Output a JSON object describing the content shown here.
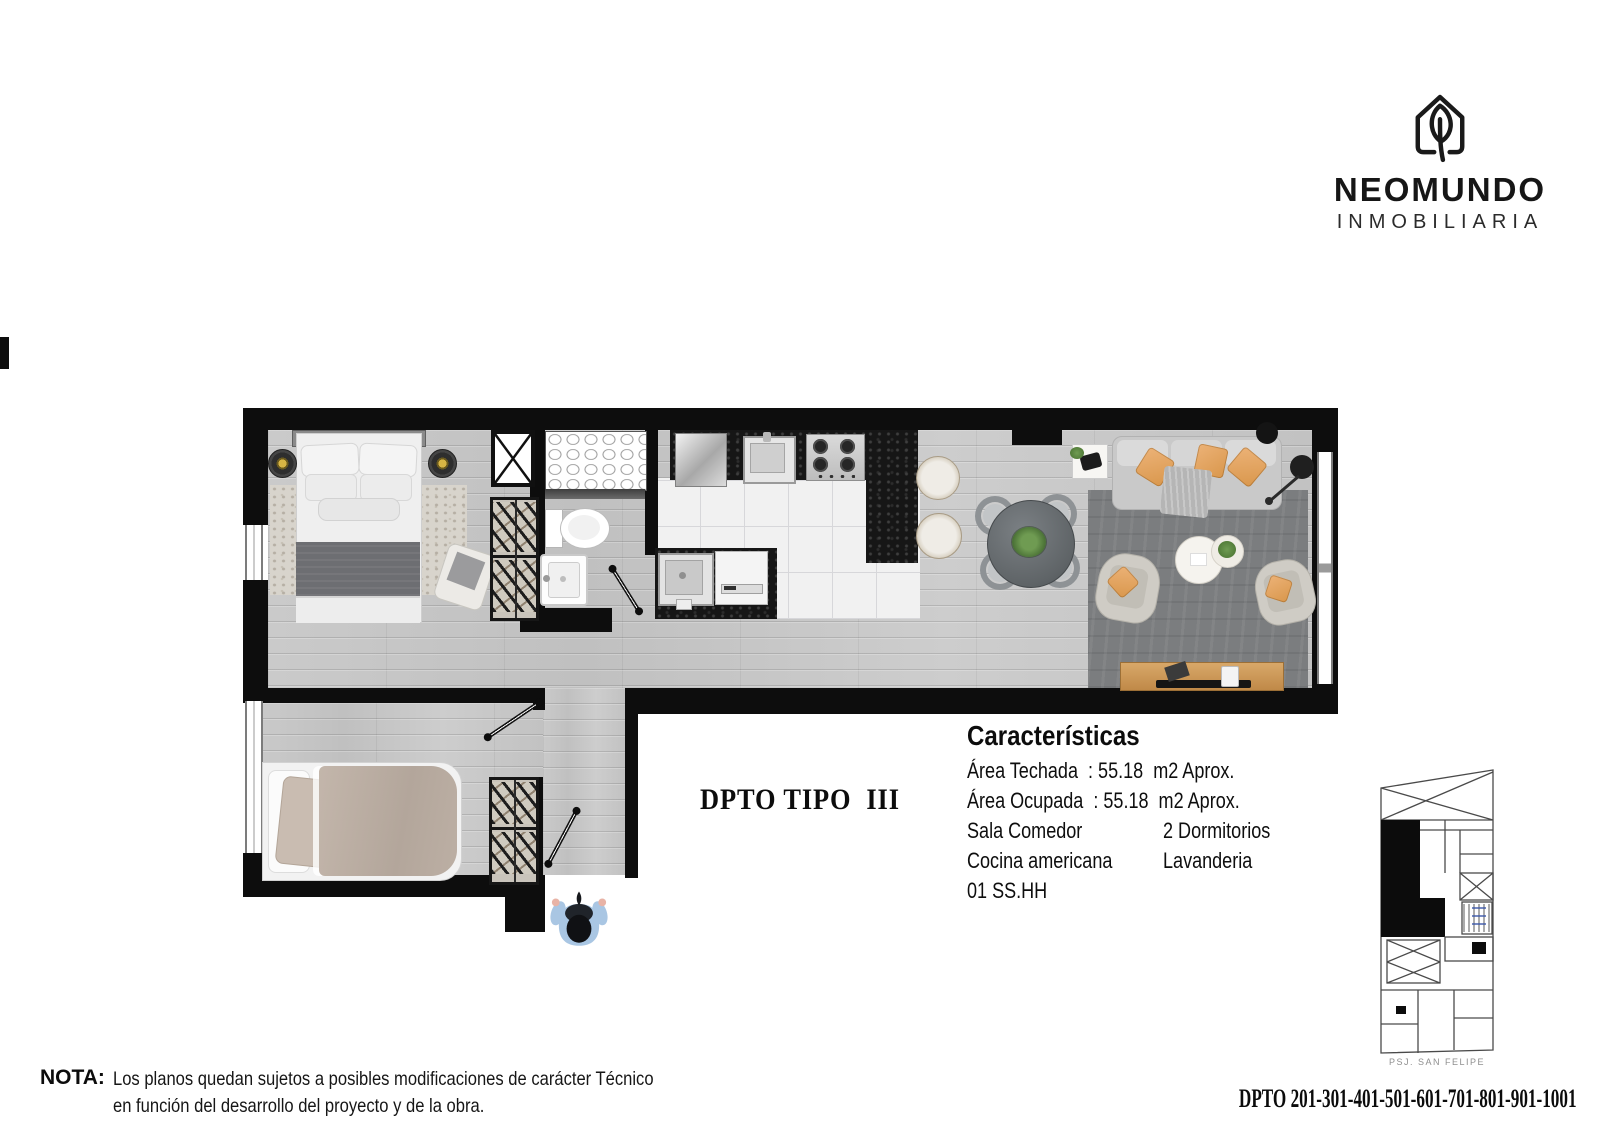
{
  "brand": {
    "name": "NEOMUNDO",
    "subtitle": "INMOBILIARIA",
    "icon": "house-leaf-icon"
  },
  "plan": {
    "type_label": "DPTO TIPO  III",
    "characteristics": {
      "title": "Características",
      "lines": [
        {
          "left": "Área Techada  : 55.18  m2 Aprox.",
          "right": ""
        },
        {
          "left": "Área Ocupada  : 55.18  m2 Aprox.",
          "right": ""
        },
        {
          "left": "Sala Comedor",
          "right": "2 Dormitorios"
        },
        {
          "left": "Cocina americana",
          "right": "Lavanderia"
        },
        {
          "left": "01 SS.HH",
          "right": ""
        }
      ]
    },
    "rooms": [
      "Dormitorio principal",
      "Dormitorio 2",
      "Baño",
      "Cocina americana",
      "Lavanderia",
      "Sala Comedor"
    ]
  },
  "note": {
    "label": "NOTA:",
    "line1": "Los planos quedan sujetos a posibles modificaciones de carácter Técnico",
    "line2": "en función del desarrollo del proyecto y de la obra."
  },
  "footer": {
    "units_label": "DPTO 201-301-401-501-601-701-801-901-1001"
  },
  "keyplan": {
    "street_label": "PSJ. SAN FELIPE"
  },
  "colors": {
    "wall": "#0d0d0d",
    "wood_floor": "#c6c6c6",
    "marble": "#f1f1f1",
    "granite": "#161616",
    "rug_living": "#7b7d7f",
    "rug_bedroom": "#d8d4cc",
    "pillow_accent": "#e0a360",
    "furniture_wood": "#cf9a5a",
    "person_blue": "#a9c6e3",
    "plant_green": "#5d8a45",
    "lamp_gold": "#d8b544",
    "caption_gray": "#8f8f8f"
  }
}
